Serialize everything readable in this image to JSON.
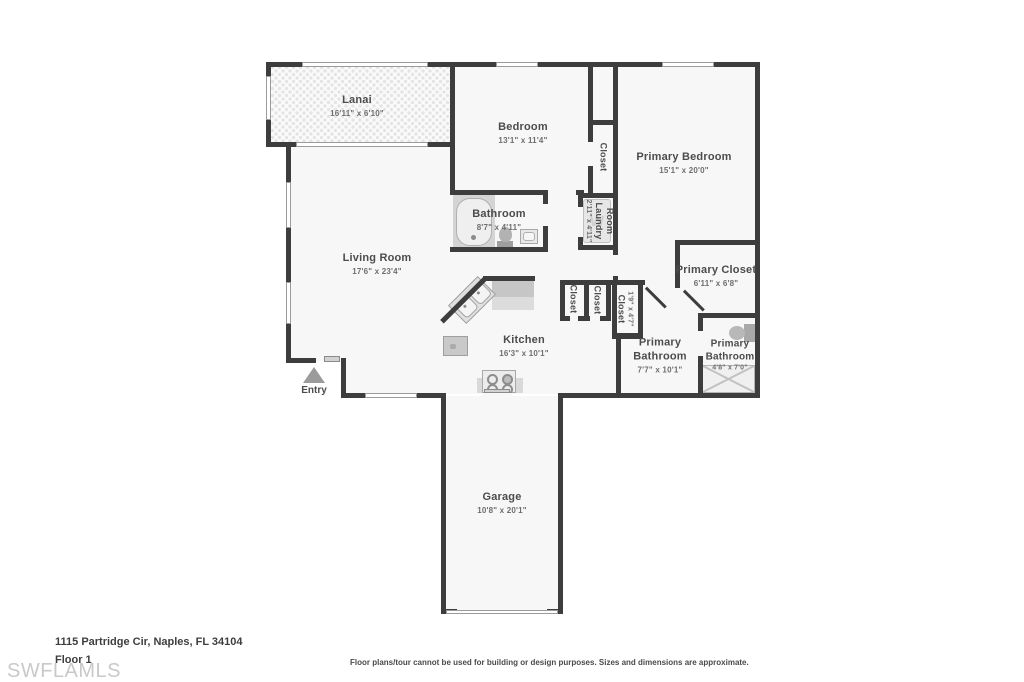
{
  "page": {
    "address": "1115 Partridge Cir, Naples, FL 34104",
    "floor_label": "Floor 1",
    "watermark": "SWFLAMLS",
    "disclaimer": "Floor plans/tour cannot be used for building or design purposes. Sizes and dimensions are approximate."
  },
  "rooms": {
    "lanai": {
      "name": "Lanai",
      "dims": "16'11\" x 6'10\""
    },
    "bedroom": {
      "name": "Bedroom",
      "dims": "13'1\" x 11'4\""
    },
    "primary_bedroom": {
      "name": "Primary Bedroom",
      "dims": "15'1\" x 20'0\""
    },
    "bedroom_closet": {
      "name": "Closet"
    },
    "bathroom": {
      "name": "Bathroom",
      "dims": "8'7\" x 4'11\""
    },
    "laundry_room": {
      "name": "Laundry Room",
      "name_lines": [
        "Laundry",
        "Room"
      ],
      "dims": "2'11\" x 4'11\""
    },
    "living_room": {
      "name": "Living Room",
      "dims": "17'6\" x 23'4\""
    },
    "primary_closet": {
      "name": "Primary Closet",
      "dims": "6'11\" x 6'8\""
    },
    "kitchen": {
      "name": "Kitchen",
      "dims": "16'3\" x 10'1\""
    },
    "hall_closet_1": {
      "name": "Closet"
    },
    "hall_closet_2": {
      "name": "Closet"
    },
    "hall_closet_3": {
      "name": "Closet",
      "dims": "1'9\" x 4'7\""
    },
    "primary_bathroom_1": {
      "name": "Primary Bathroom",
      "dims": "7'7\" x 10'1\""
    },
    "primary_bathroom_2": {
      "name": "Primary Bathroom",
      "dims": "4'8\" x 7'0\""
    },
    "entry": {
      "name": "Entry"
    },
    "garage": {
      "name": "Garage",
      "dims": "10'8\" x 20'1\""
    },
    "washer_glyph": "W"
  },
  "colors": {
    "wall": "#3d3d3d",
    "floor": "#f7f7f7",
    "fixture_gray": "#c9c9c9",
    "label_text": "#4c4c4c",
    "watermark_gray": "#c9c9c9"
  }
}
